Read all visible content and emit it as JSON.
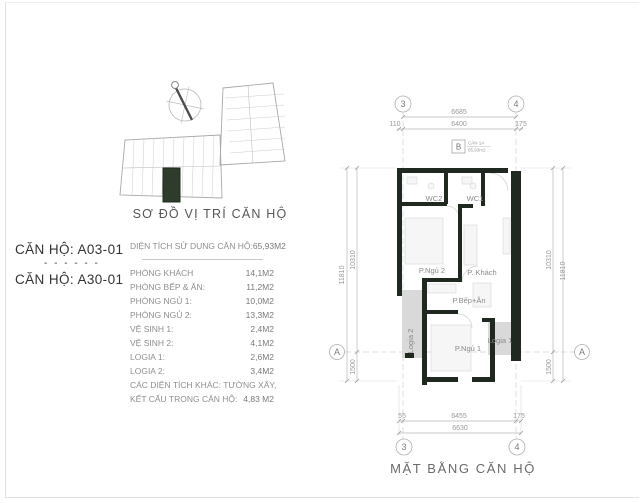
{
  "site_plan": {
    "caption": "SƠ ĐỒ VỊ TRÍ CĂN HỘ"
  },
  "info": {
    "unit_1": "CĂN HỘ: A03-01",
    "divider": "- - - - - -",
    "unit_2": "CĂN HỘ: A30-01",
    "total_label": "DIỆN TÍCH SỬ DỤNG CĂN HỘ:",
    "total_value": "65,93M2",
    "rows": [
      {
        "label": "PHÒNG KHÁCH",
        "value": "14,1M2"
      },
      {
        "label": "PHÒNG BẾP & ĂN:",
        "value": "11,2M2"
      },
      {
        "label": "PHÒNG NGỦ 1:",
        "value": "10,0M2"
      },
      {
        "label": "PHÒNG NGỦ 2:",
        "value": "13,3M2"
      },
      {
        "label": "VỆ SINH 1:",
        "value": "2,4M2"
      },
      {
        "label": "VỆ SINH 2:",
        "value": "4,1M2"
      },
      {
        "label": "LOGIA 1:",
        "value": "2,6M2"
      },
      {
        "label": "LOGIA 2:",
        "value": "3,4M2"
      },
      {
        "label": "CÁC DIỆN TÍCH KHÁC: TƯỜNG XÂY,",
        "value": ""
      },
      {
        "label": "KẾT CẤU TRONG CĂN HỘ:",
        "value": "4,83 M2"
      }
    ]
  },
  "plan": {
    "caption": "MẶT BẰNG CĂN HỘ",
    "tag_letter": "B",
    "tag_line1": "CĂN 1A",
    "tag_line2": "65,93m2",
    "grid": {
      "c3": "3",
      "c4": "4",
      "a": "A"
    },
    "dims": {
      "top_total": "6685",
      "top_1": "110",
      "top_2": "6400",
      "top_3": "175",
      "bot_1": "55",
      "bot_2": "6455",
      "bot_3": "175",
      "bot_total": "6630",
      "left_outer": "11810",
      "left_inner": "10310",
      "left_low": "1500",
      "right_inner": "10310",
      "right_outer": "11810",
      "right_low": "1500"
    },
    "rooms": {
      "wc2": "WC2",
      "wc1": "WC1",
      "bed2": "P.Ngủ 2",
      "living": "P. Khách",
      "kitchen": "P.Bếp+Ăn",
      "bed1": "P.Ngủ 1",
      "logia1": "Logia 1",
      "logia2": "Logia 2"
    }
  },
  "colors": {
    "wall": "#20291f",
    "unit_highlight": "#2e3d2b",
    "hatch": "#d9d9d9"
  }
}
